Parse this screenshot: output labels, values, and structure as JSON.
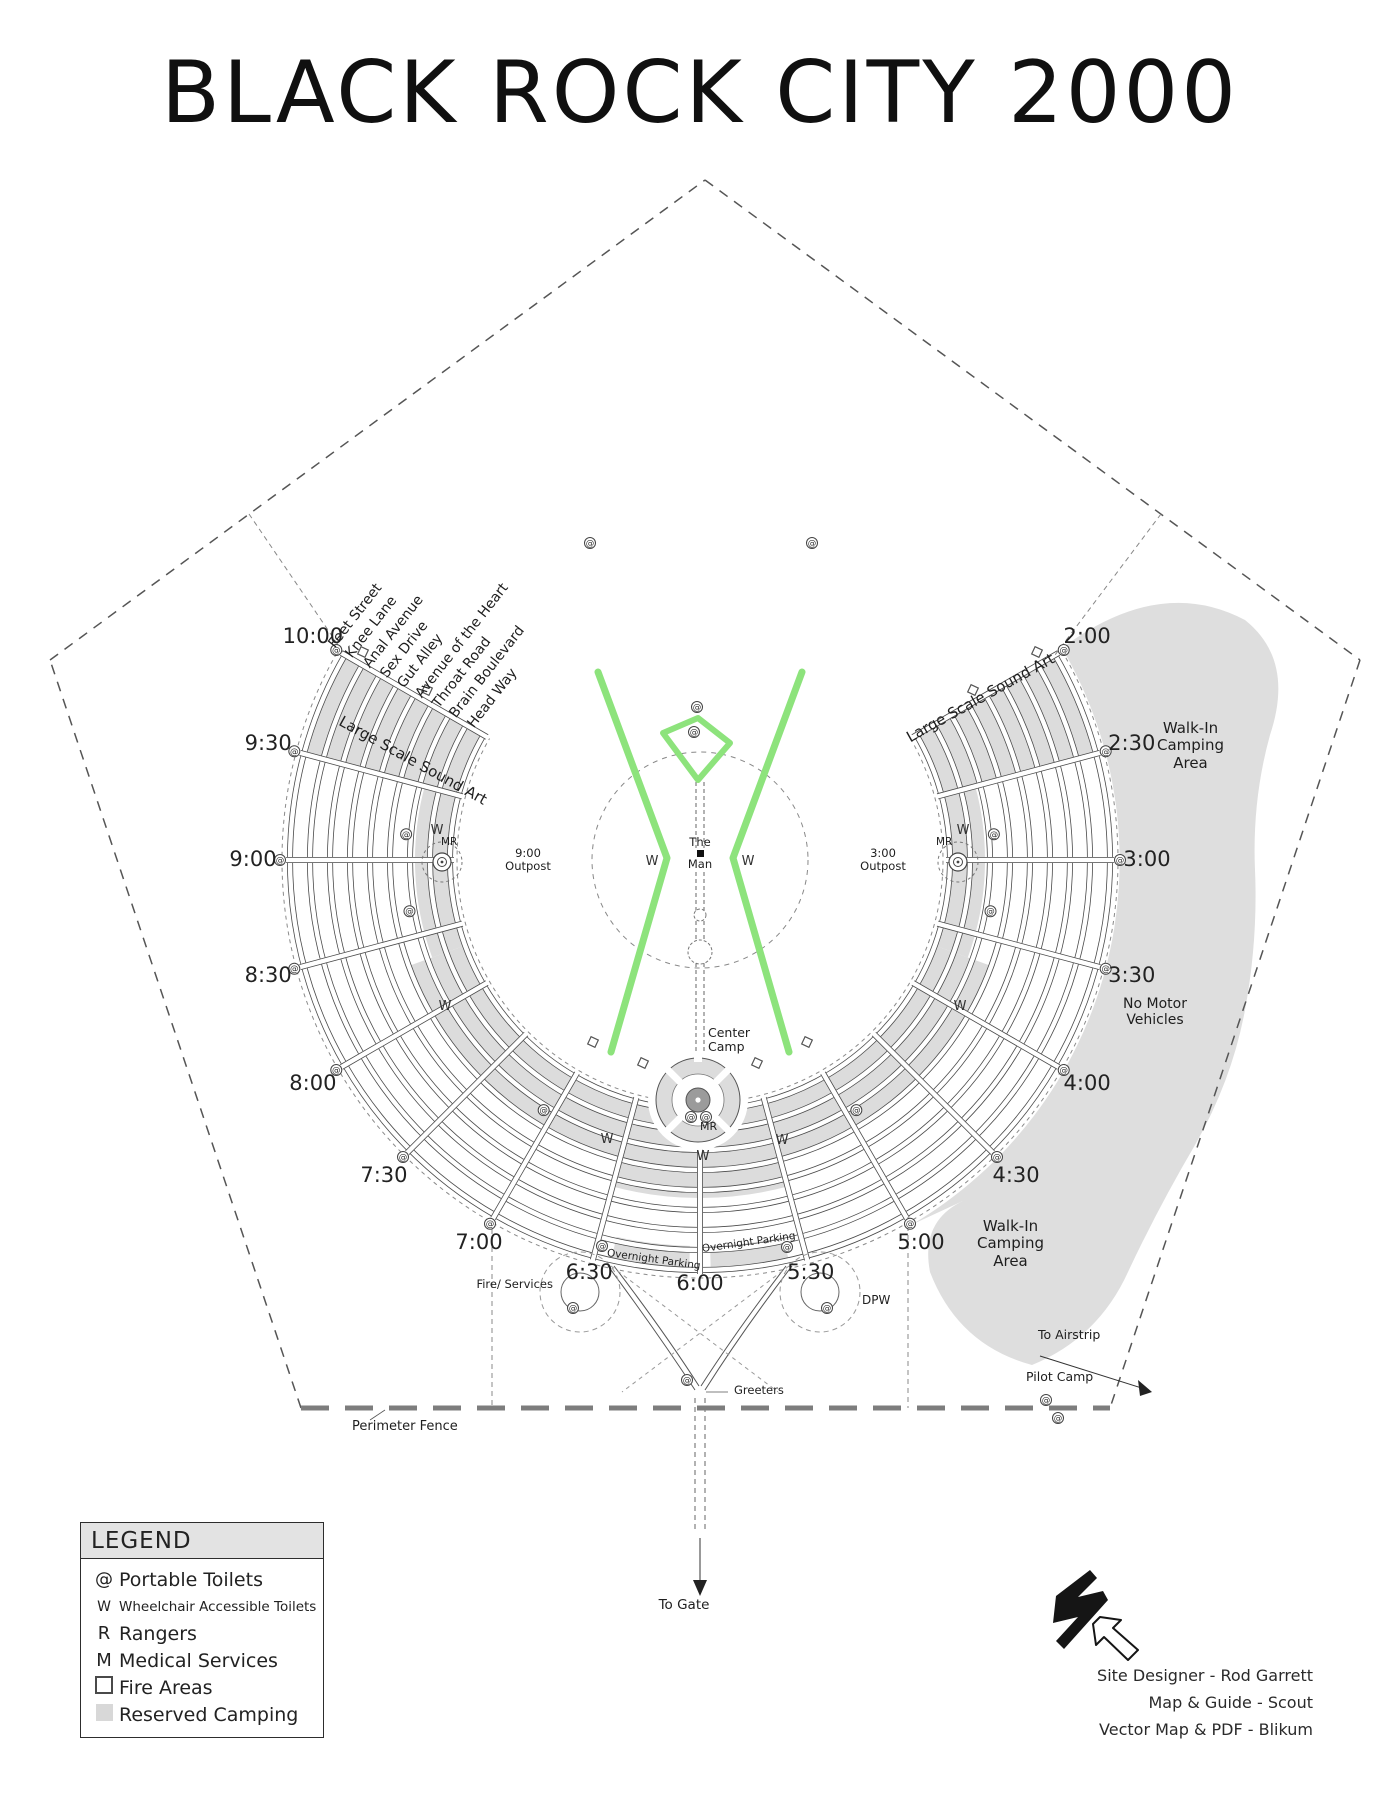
{
  "title": "BLACK ROCK CITY 2000",
  "colors": {
    "ink": "#2f2f2f",
    "street_edge": "#4a4a4a",
    "gray_fill": "#dcdcdc",
    "gray_blob": "#dedede",
    "green": "#8DE37C",
    "fence": "#7d7d7d",
    "camp_center": "#9b9b9b"
  },
  "symbols": {
    "toilet": "@",
    "wheelchair": "W"
  },
  "clock_labels": [
    "10:00",
    "9:30",
    "9:00",
    "8:30",
    "8:00",
    "7:30",
    "7:00",
    "6:30",
    "6:00",
    "5:30",
    "5:00",
    "4:30",
    "4:00",
    "3:30",
    "3:00",
    "2:30",
    "2:00"
  ],
  "street_names": [
    "Feet Street",
    "Knee Lane",
    "Anal Avenue",
    "Sex Drive",
    "Gut Alley",
    "Avenue of the Heart",
    "Throat Road",
    "Brain Boulevard",
    "Head Way"
  ],
  "labels": {
    "the": "The",
    "man": "Man",
    "center_camp": "Center Camp",
    "mr": "MR",
    "outpost_left": "9:00 Outpost",
    "outpost_right": "3:00 Outpost",
    "sound_art": "Large Scale Sound Art",
    "walk_in": "Walk-In Camping Area",
    "no_motor": "No Motor Vehicles",
    "overnight_parking": "Overnight Parking",
    "fire_services": "Fire/ Services",
    "dpw": "DPW",
    "greeters": "Greeters",
    "to_gate": "To Gate",
    "to_airstrip": "To Airstrip",
    "pilot_camp": "Pilot Camp",
    "perimeter_fence": "Perimeter Fence"
  },
  "legend": {
    "title": "LEGEND",
    "items": [
      {
        "kind": "at",
        "symbol": "@",
        "label": "Portable Toilets"
      },
      {
        "kind": "w",
        "symbol": "W",
        "label": "Wheelchair Accessible Toilets"
      },
      {
        "kind": "r",
        "symbol": "R",
        "label": "Rangers"
      },
      {
        "kind": "m",
        "symbol": "M",
        "label": "Medical Services"
      },
      {
        "kind": "fire",
        "symbol": "",
        "label": "Fire Areas"
      },
      {
        "kind": "camp",
        "symbol": "",
        "label": "Reserved Camping"
      }
    ]
  },
  "credits": [
    "Site Designer - Rod Garrett",
    "Map & Guide - Scout",
    "Vector Map & PDF - Blikum"
  ]
}
